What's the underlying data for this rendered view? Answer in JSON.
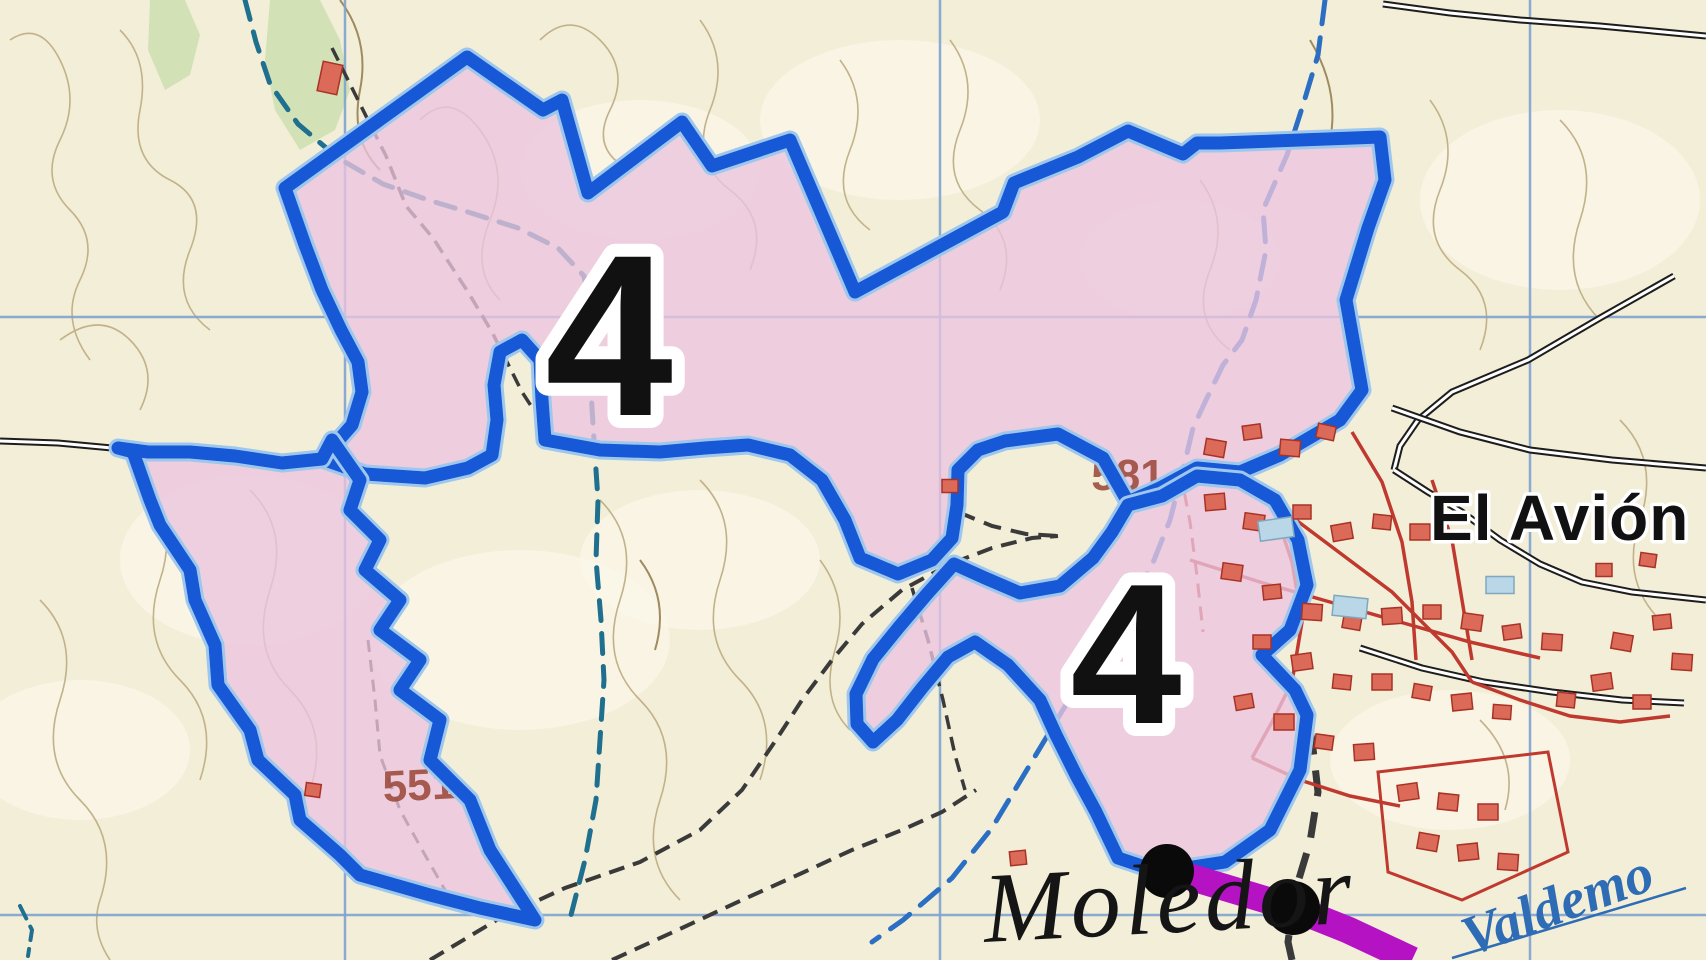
{
  "map": {
    "width": 1706,
    "height": 960,
    "colors": {
      "background": "#f3eed8",
      "light_patch": "#fbf7ea",
      "contour": "#c2b28a",
      "contour_dark": "#a08b60",
      "grid": "#7fa3cf",
      "zone_fill": "#eac4df",
      "zone_border": "#1658d6",
      "zone_border_halo": "#9ec7ee",
      "stream": "#2a6fc4",
      "stream_dark": "#1f6f8f",
      "green": "#ccdfb0",
      "track": "#3a3a3a",
      "road_casing": "#1d1d1d",
      "road_fill": "#ffffff",
      "village_red": "#c0392f",
      "building_red": "#dc6a58",
      "building_red_border": "#a83226",
      "building_blue": "#b9d7e6",
      "building_blue_border": "#7fa8c0",
      "purple_road": "#b512c4",
      "dot_black": "#0a0a0a",
      "spot_height": "#9c4a3c",
      "stream_label": "#2e6db6"
    },
    "labels": [
      {
        "id": "zone-number-1",
        "text": "4",
        "x": 609,
        "y": 415,
        "size": 230,
        "rotate": 0,
        "anchor": "middle"
      },
      {
        "id": "zone-number-2",
        "text": "4",
        "x": 1126,
        "y": 723,
        "size": 200,
        "rotate": 0,
        "anchor": "middle"
      },
      {
        "id": "spot-551",
        "text": "551",
        "x": 420,
        "y": 800,
        "size": 44,
        "rotate": -3,
        "anchor": "middle"
      },
      {
        "id": "spot-581",
        "text": "581",
        "x": 1128,
        "y": 490,
        "size": 44,
        "rotate": 0,
        "anchor": "middle"
      },
      {
        "id": "place-el-avion",
        "text": "El Avión",
        "x": 1430,
        "y": 540,
        "size": 64,
        "rotate": 0,
        "anchor": "start"
      },
      {
        "id": "place-moledor",
        "text": "Moledor",
        "x": 985,
        "y": 942,
        "size": 100,
        "rotate": -3,
        "anchor": "start"
      },
      {
        "id": "stream-valdemoro",
        "text": "Valdemo",
        "x": 1470,
        "y": 956,
        "size": 56,
        "rotate": -20,
        "anchor": "start"
      }
    ],
    "grid": {
      "vertical_x": [
        345,
        940,
        1530
      ],
      "horizontal_y": [
        317,
        915
      ]
    },
    "zones": [
      {
        "id": "zone-4-main",
        "points": "285,188 305,245 322,290 341,330 358,362 362,392 352,425 322,459 365,474 425,478 468,468 492,455 497,420 494,385 500,352 522,340 540,360 542,400 545,440 600,450 660,452 705,448 748,445 790,455 822,480 845,520 860,558 898,574 932,560 952,538 957,505 958,470 978,450 1005,441 1058,434 1103,458 1128,502 1160,488 1197,468 1240,472 1280,455 1340,420 1362,390 1346,300 1368,228 1385,180 1380,137 1220,143 1197,143 1183,154 1128,131 1078,157 1014,183 1003,212 855,292 790,140 712,166 682,122 588,193 562,100 543,110 467,57"
      },
      {
        "id": "zone-4-left-lobe",
        "points": "322,459 282,463 235,456 190,452 148,452 118,448 133,452 150,500 160,525 190,570 195,600 215,645 218,685 250,730 258,760 295,795 300,820 340,855 360,875 430,895 480,908 535,920 490,850 470,800 430,760 440,720 400,690 420,660 380,630 400,600 365,570 380,540 350,510 360,480 332,440"
      },
      {
        "id": "zone-4-right-lobe",
        "points": "1128,505 1112,532 1093,558 1060,586 1020,593 985,578 954,564 927,594 899,627 873,659 856,694 857,724 873,742 897,720 922,688 948,657 975,642 1008,665 1040,700 1056,735 1076,775 1096,812 1118,858 1160,872 1225,862 1270,830 1300,770 1307,715 1295,690 1262,655 1290,630 1307,585 1298,540 1275,500 1240,480 1197,476 1162,496"
      }
    ],
    "streams": [
      {
        "id": "stream-west",
        "color": "stream_dark",
        "width": 5,
        "dash": "20 13",
        "points": "245,0 256,42 270,84 298,124 338,158 383,184 428,200 468,212 518,228 558,248 584,276 591,312 587,352 591,392 594,440 598,500 596,560 601,620 604,680 600,740 596,800 585,860 571,915"
      },
      {
        "id": "stream-east",
        "color": "stream",
        "width": 5,
        "dash": "24 14",
        "points": "1325,0 1318,55 1303,105 1287,155 1263,210 1266,250 1256,300 1242,340 1223,365 1206,400 1193,428 1183,470 1170,520 1152,565 1122,620 1082,678 1052,728 1022,778 992,828 952,878 903,920 872,942"
      },
      {
        "id": "stream-sw-corner",
        "color": "stream_dark",
        "width": 4,
        "dash": "14 9",
        "points": "20,906 32,930 28,956"
      }
    ],
    "tracks": [
      {
        "id": "track-upper-zone",
        "width": 3.5,
        "dash": "14 8",
        "points": "332,48 356,96 386,156 406,206 433,238 468,292 492,332 522,392 548,432"
      },
      {
        "id": "track-valley-main",
        "width": 4,
        "dash": "16 9",
        "points": "430,960 500,918 565,888 640,862 700,830 742,790 776,740 802,700 832,660 862,624 902,590 950,564 992,548 1032,538 1058,536"
      },
      {
        "id": "track-valley-south",
        "width": 4,
        "dash": "16 9",
        "points": "612,960 682,928 742,900 802,873 852,850 902,830 942,812 976,790"
      },
      {
        "id": "track-valley-branch",
        "width": 3.5,
        "dash": "14 8",
        "points": "912,588 928,640 943,700 955,755 965,790"
      },
      {
        "id": "track-pocket",
        "width": 4,
        "dash": "18 10",
        "points": "958,512 992,526 1026,534 1058,536"
      },
      {
        "id": "track-lobe",
        "width": 3,
        "dash": "12 8",
        "points": "368,640 375,700 380,755 400,810 425,855 445,890"
      },
      {
        "id": "track-village-south",
        "width": 7,
        "dash": "26 16",
        "points": "1300,688 1312,740 1318,792 1310,842 1295,892 1288,942 1292,960"
      }
    ],
    "roads_black": [
      {
        "id": "road-top-right",
        "points": "1383,4 1450,13 1520,20 1600,26 1706,36"
      },
      {
        "id": "road-ne-diagonal",
        "points": "1674,276 1600,318 1528,360 1452,392 1418,420 1400,446 1394,470"
      },
      {
        "id": "road-village-main",
        "points": "1394,470 1428,492 1462,512 1500,540 1540,564 1582,582 1632,592 1706,600"
      },
      {
        "id": "road-village-upper",
        "points": "1392,408 1460,432 1530,450 1612,460 1706,468"
      },
      {
        "id": "road-village-lower",
        "points": "1360,648 1422,668 1484,682 1552,692 1622,700 1684,703"
      },
      {
        "id": "road-west-edge",
        "points": "0,441 58,443 112,448"
      }
    ],
    "roads_red": [
      {
        "id": "street-ring",
        "points": "1193,470 1232,482 1272,502 1312,532 1352,562 1392,592 1422,622 1452,652 1472,682"
      },
      {
        "id": "street-a",
        "points": "1272,502 1292,562 1302,622 1292,682 1272,722 1252,758"
      },
      {
        "id": "street-b",
        "points": "1190,560 1260,582 1330,602 1400,622 1470,642 1540,658"
      },
      {
        "id": "street-c",
        "points": "1352,432 1382,482 1402,542 1412,602 1416,660"
      },
      {
        "id": "street-d",
        "points": "1432,480 1452,540 1462,600 1472,660"
      },
      {
        "id": "street-se",
        "points": "1472,682 1520,700 1570,716 1620,722 1670,716"
      },
      {
        "id": "street-s",
        "points": "1252,758 1300,780 1350,796 1400,806"
      }
    ],
    "red_dashed": [
      {
        "id": "village-limit",
        "points": "1180,470 1190,522 1197,576 1203,632"
      }
    ],
    "contours": [
      "M10,40 Q40,20 60,60 Q80,100 60,140 Q40,180 70,210 Q100,240 80,280 Q60,320 90,360",
      "M120,30 Q150,60 140,110 Q130,160 170,180 Q210,200 190,250 Q170,300 210,330",
      "M60,340 Q100,310 130,340 Q160,370 140,410",
      "M140,480 Q180,520 160,580 Q140,640 180,680 Q220,720 200,780",
      "M40,600 Q80,640 60,700 Q40,760 80,800 Q120,840 100,900 Q90,930 110,960",
      "M250,490 Q290,530 270,590 Q250,650 290,690 Q330,730 310,790",
      "M420,120 Q450,90 480,130 Q510,170 490,220 Q470,270 500,300",
      "M540,40 Q570,10 600,40 Q630,70 610,110 Q590,150 630,170",
      "M700,20 Q730,60 710,110 Q690,160 730,190 Q770,220 750,270",
      "M840,60 Q870,100 850,150 Q830,200 870,230",
      "M950,40 Q980,80 960,130 Q940,180 980,210 Q1020,240 1000,290",
      "M600,500 Q640,540 620,600 Q600,660 640,700 Q680,740 660,800 Q640,860 680,900",
      "M700,480 Q740,520 720,580 Q700,640 740,680 Q780,720 760,780",
      "M1200,180 Q1230,220 1210,270 Q1190,320 1230,350",
      "M1430,100 Q1460,140 1440,190 Q1420,240 1460,270 Q1500,300 1480,350",
      "M1560,120 Q1600,160 1580,220 Q1560,280 1600,320",
      "M1620,420 Q1660,460 1640,520 Q1620,580 1660,620",
      "M1480,720 Q1520,760 1505,810",
      "M820,560 Q850,600 835,650 Q820,700 850,730"
    ],
    "contours_dark": [
      "M340,0 Q370,40 360,90 Q350,140 380,170",
      "M1310,40 Q1340,90 1330,140",
      "M640,560 Q670,600 655,650"
    ],
    "green_areas": [
      {
        "id": "veg-band",
        "points": "270,0 320,0 340,40 350,90 335,130 300,150 275,110 265,60"
      },
      {
        "id": "veg-left",
        "points": "150,0 185,0 200,35 190,75 165,90 148,50"
      }
    ],
    "light_patches": [
      [
        640,
        170,
        120,
        70
      ],
      [
        900,
        120,
        140,
        80
      ],
      [
        1560,
        200,
        140,
        90
      ],
      [
        250,
        560,
        130,
        85
      ],
      [
        520,
        640,
        150,
        90
      ],
      [
        700,
        560,
        120,
        70
      ],
      [
        1180,
        260,
        100,
        60
      ],
      [
        80,
        750,
        110,
        70
      ],
      [
        1450,
        760,
        120,
        70
      ]
    ],
    "buildings_red": [
      [
        330,
        78,
        20,
        30,
        12
      ],
      [
        950,
        486,
        16,
        13,
        0
      ],
      [
        313,
        790,
        15,
        13,
        8
      ],
      [
        1018,
        858,
        16,
        14,
        -6
      ],
      [
        1215,
        448,
        20,
        16,
        10
      ],
      [
        1252,
        432,
        18,
        14,
        -8
      ],
      [
        1290,
        448,
        20,
        16,
        5
      ],
      [
        1326,
        432,
        18,
        14,
        12
      ],
      [
        1215,
        502,
        20,
        16,
        -5
      ],
      [
        1254,
        522,
        20,
        16,
        8
      ],
      [
        1302,
        512,
        18,
        14,
        0
      ],
      [
        1342,
        532,
        20,
        16,
        -10
      ],
      [
        1382,
        522,
        18,
        14,
        6
      ],
      [
        1420,
        532,
        20,
        16,
        0
      ],
      [
        1232,
        572,
        20,
        16,
        8
      ],
      [
        1272,
        592,
        18,
        14,
        -6
      ],
      [
        1312,
        612,
        20,
        16,
        4
      ],
      [
        1352,
        622,
        18,
        14,
        10
      ],
      [
        1392,
        616,
        20,
        16,
        -4
      ],
      [
        1432,
        612,
        18,
        14,
        0
      ],
      [
        1472,
        622,
        20,
        16,
        8
      ],
      [
        1512,
        632,
        18,
        14,
        -8
      ],
      [
        1552,
        642,
        20,
        16,
        4
      ],
      [
        1262,
        642,
        18,
        14,
        0
      ],
      [
        1302,
        662,
        20,
        16,
        -8
      ],
      [
        1342,
        682,
        18,
        14,
        6
      ],
      [
        1382,
        682,
        20,
        16,
        0
      ],
      [
        1422,
        692,
        18,
        14,
        10
      ],
      [
        1462,
        702,
        20,
        16,
        -6
      ],
      [
        1502,
        712,
        18,
        14,
        4
      ],
      [
        1244,
        702,
        18,
        14,
        -10
      ],
      [
        1284,
        722,
        20,
        16,
        0
      ],
      [
        1324,
        742,
        18,
        14,
        8
      ],
      [
        1364,
        752,
        20,
        16,
        -4
      ],
      [
        1566,
        700,
        18,
        14,
        6
      ],
      [
        1602,
        682,
        20,
        16,
        -8
      ],
      [
        1642,
        702,
        18,
        14,
        0
      ],
      [
        1622,
        642,
        20,
        16,
        10
      ],
      [
        1662,
        622,
        18,
        14,
        -6
      ],
      [
        1682,
        662,
        20,
        16,
        4
      ],
      [
        1604,
        570,
        16,
        13,
        0
      ],
      [
        1648,
        560,
        16,
        13,
        8
      ],
      [
        1408,
        792,
        20,
        16,
        -8
      ],
      [
        1448,
        802,
        20,
        16,
        6
      ],
      [
        1488,
        812,
        20,
        16,
        0
      ],
      [
        1428,
        842,
        20,
        16,
        10
      ],
      [
        1468,
        852,
        20,
        16,
        -6
      ],
      [
        1508,
        862,
        20,
        16,
        4
      ]
    ],
    "buildings_blue": [
      [
        1276,
        529,
        34,
        20,
        -8
      ],
      [
        1350,
        607,
        34,
        20,
        6
      ],
      [
        1500,
        585,
        28,
        17,
        0
      ]
    ],
    "compound": {
      "id": "walled-compound",
      "points": "1378,772 1548,752 1568,852 1462,900 1388,872"
    },
    "purple_road": {
      "points": "1146,864 1170,871 1293,908 1348,930 1412,960",
      "width": 27,
      "dots": [
        [
          1167,
          871
        ],
        [
          1293,
          908
        ]
      ],
      "dot_radius": 27
    },
    "valdemoro_underline": {
      "x1": 1452,
      "y1": 958,
      "x2": 1686,
      "y2": 888
    }
  }
}
